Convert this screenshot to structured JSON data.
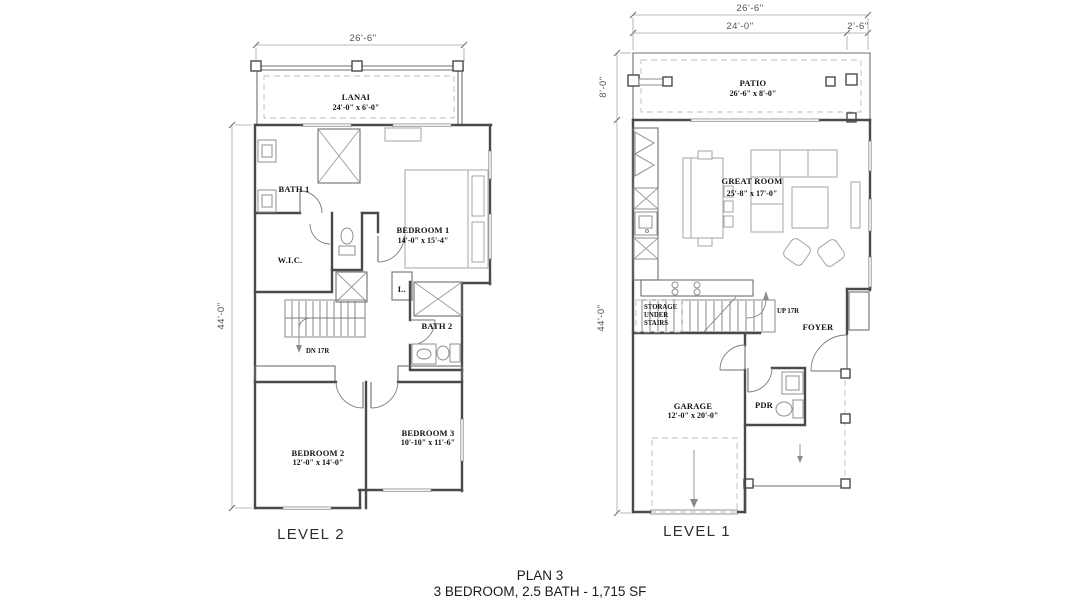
{
  "meta": {
    "drawing_type": "residential floor plan",
    "background_color": "#ffffff",
    "line_color": "#4a4a4a"
  },
  "footer": {
    "plan": "PLAN 3",
    "subtitle": "3 BEDROOM, 2.5 BATH - 1,715 SF"
  },
  "level2": {
    "caption": "LEVEL 2",
    "dims": {
      "width": "26'-6\"",
      "height": "44'-0\""
    },
    "stairs": "DN 17R",
    "rooms": {
      "lanai": {
        "name": "LANAI",
        "size": "24'-0\" x 6'-0\""
      },
      "bath1": {
        "name": "BATH 1"
      },
      "wic": {
        "name": "W.I.C."
      },
      "bedroom1": {
        "name": "BEDROOM 1",
        "size": "14'-0\" x 15'-4\""
      },
      "linen": {
        "name": "L."
      },
      "bath2": {
        "name": "BATH 2"
      },
      "bedroom2": {
        "name": "BEDROOM 2",
        "size": "12'-0\" x 14'-0\""
      },
      "bedroom3": {
        "name": "BEDROOM 3",
        "size": "10'-10\" x 11'-6\""
      }
    }
  },
  "level1": {
    "caption": "LEVEL 1",
    "dims": {
      "width_overall": "26'-6\"",
      "width_main": "24'-0\"",
      "width_side": "2'-6\"",
      "patio_depth": "8'-0\"",
      "height": "44'-0\""
    },
    "stairs": "UP 17R",
    "storage_lines": [
      "STORAGE",
      "UNDER",
      "STAIRS"
    ],
    "rooms": {
      "patio": {
        "name": "PATIO",
        "size": "26'-6\" x 8'-0\""
      },
      "great_room": {
        "name": "GREAT ROOM",
        "size": "25'-8\" x 17'-0\""
      },
      "foyer": {
        "name": "FOYER"
      },
      "garage": {
        "name": "GARAGE",
        "size": "12'-0\" x 20'-0\""
      },
      "pdr": {
        "name": "PDR"
      }
    }
  }
}
